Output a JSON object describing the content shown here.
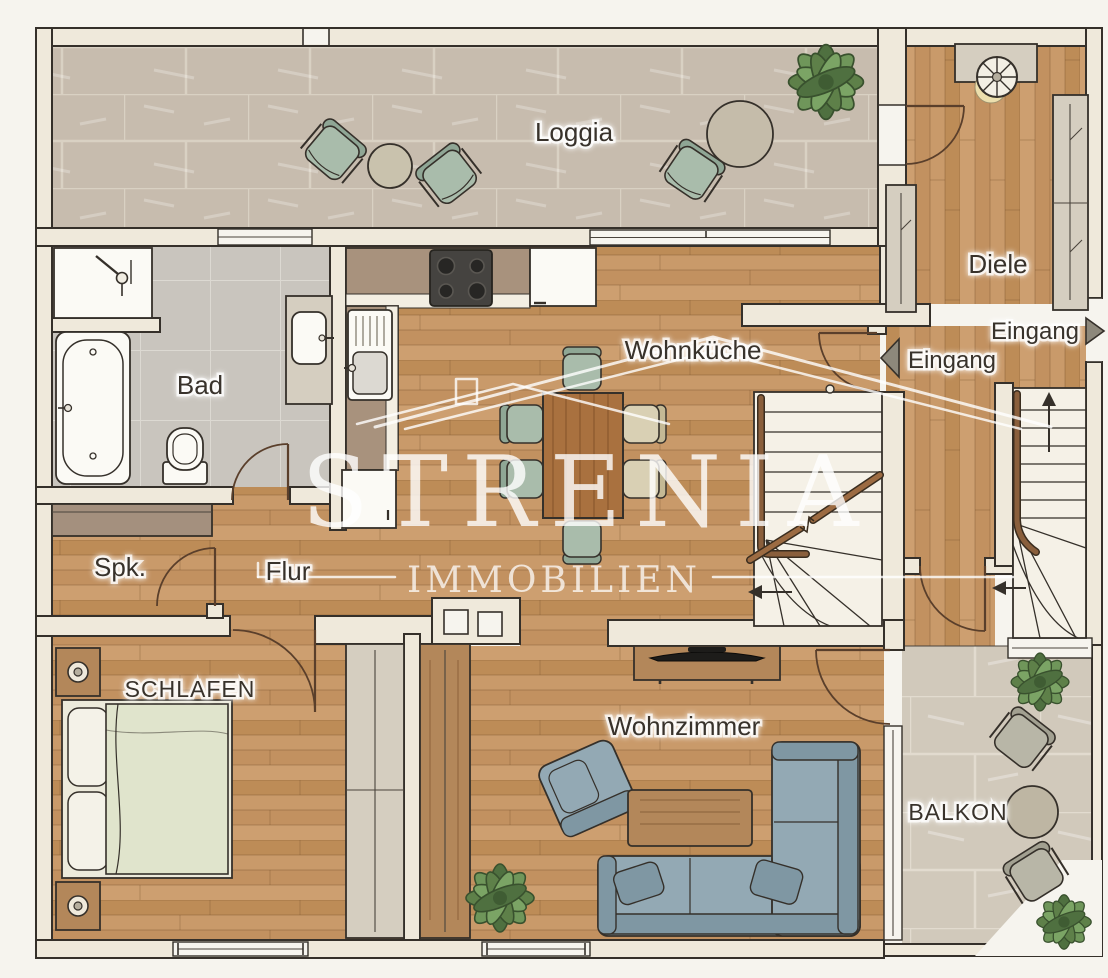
{
  "watermark": {
    "brand": "STRENIA",
    "division": "IMMOBILIEN"
  },
  "labels": {
    "loggia": "Loggia",
    "diele": "Diele",
    "bad": "Bad",
    "wohnkueche": "Wohnküche",
    "spk": "Spk.",
    "flur": "Flur",
    "schlafen": "SCHLAFEN",
    "wohnzimmer": "Wohnzimmer",
    "balkon": "BALKON"
  },
  "entrances": {
    "eingang_right": "Eingang",
    "eingang_left": "Eingang"
  },
  "colors": {
    "paper": "#f6f4ee",
    "wall_fill": "#efe9db",
    "outline": "#35302a",
    "wood_floor": "#c49566",
    "loggia_tile": "#c7bcae",
    "balcony_tile": "#d1c9bb",
    "bath_tile": "#c9c5be",
    "counter": "#a8927d",
    "sofa": "#93a9b4",
    "chair_sage": "#a9bcab",
    "chair_cream": "#d9d0b4",
    "furniture_wood": "#b3875a",
    "label_text": "#38322b",
    "door_swing": "#5a3f2b",
    "watermark_white": "rgba(255,255,255,0.8)"
  }
}
